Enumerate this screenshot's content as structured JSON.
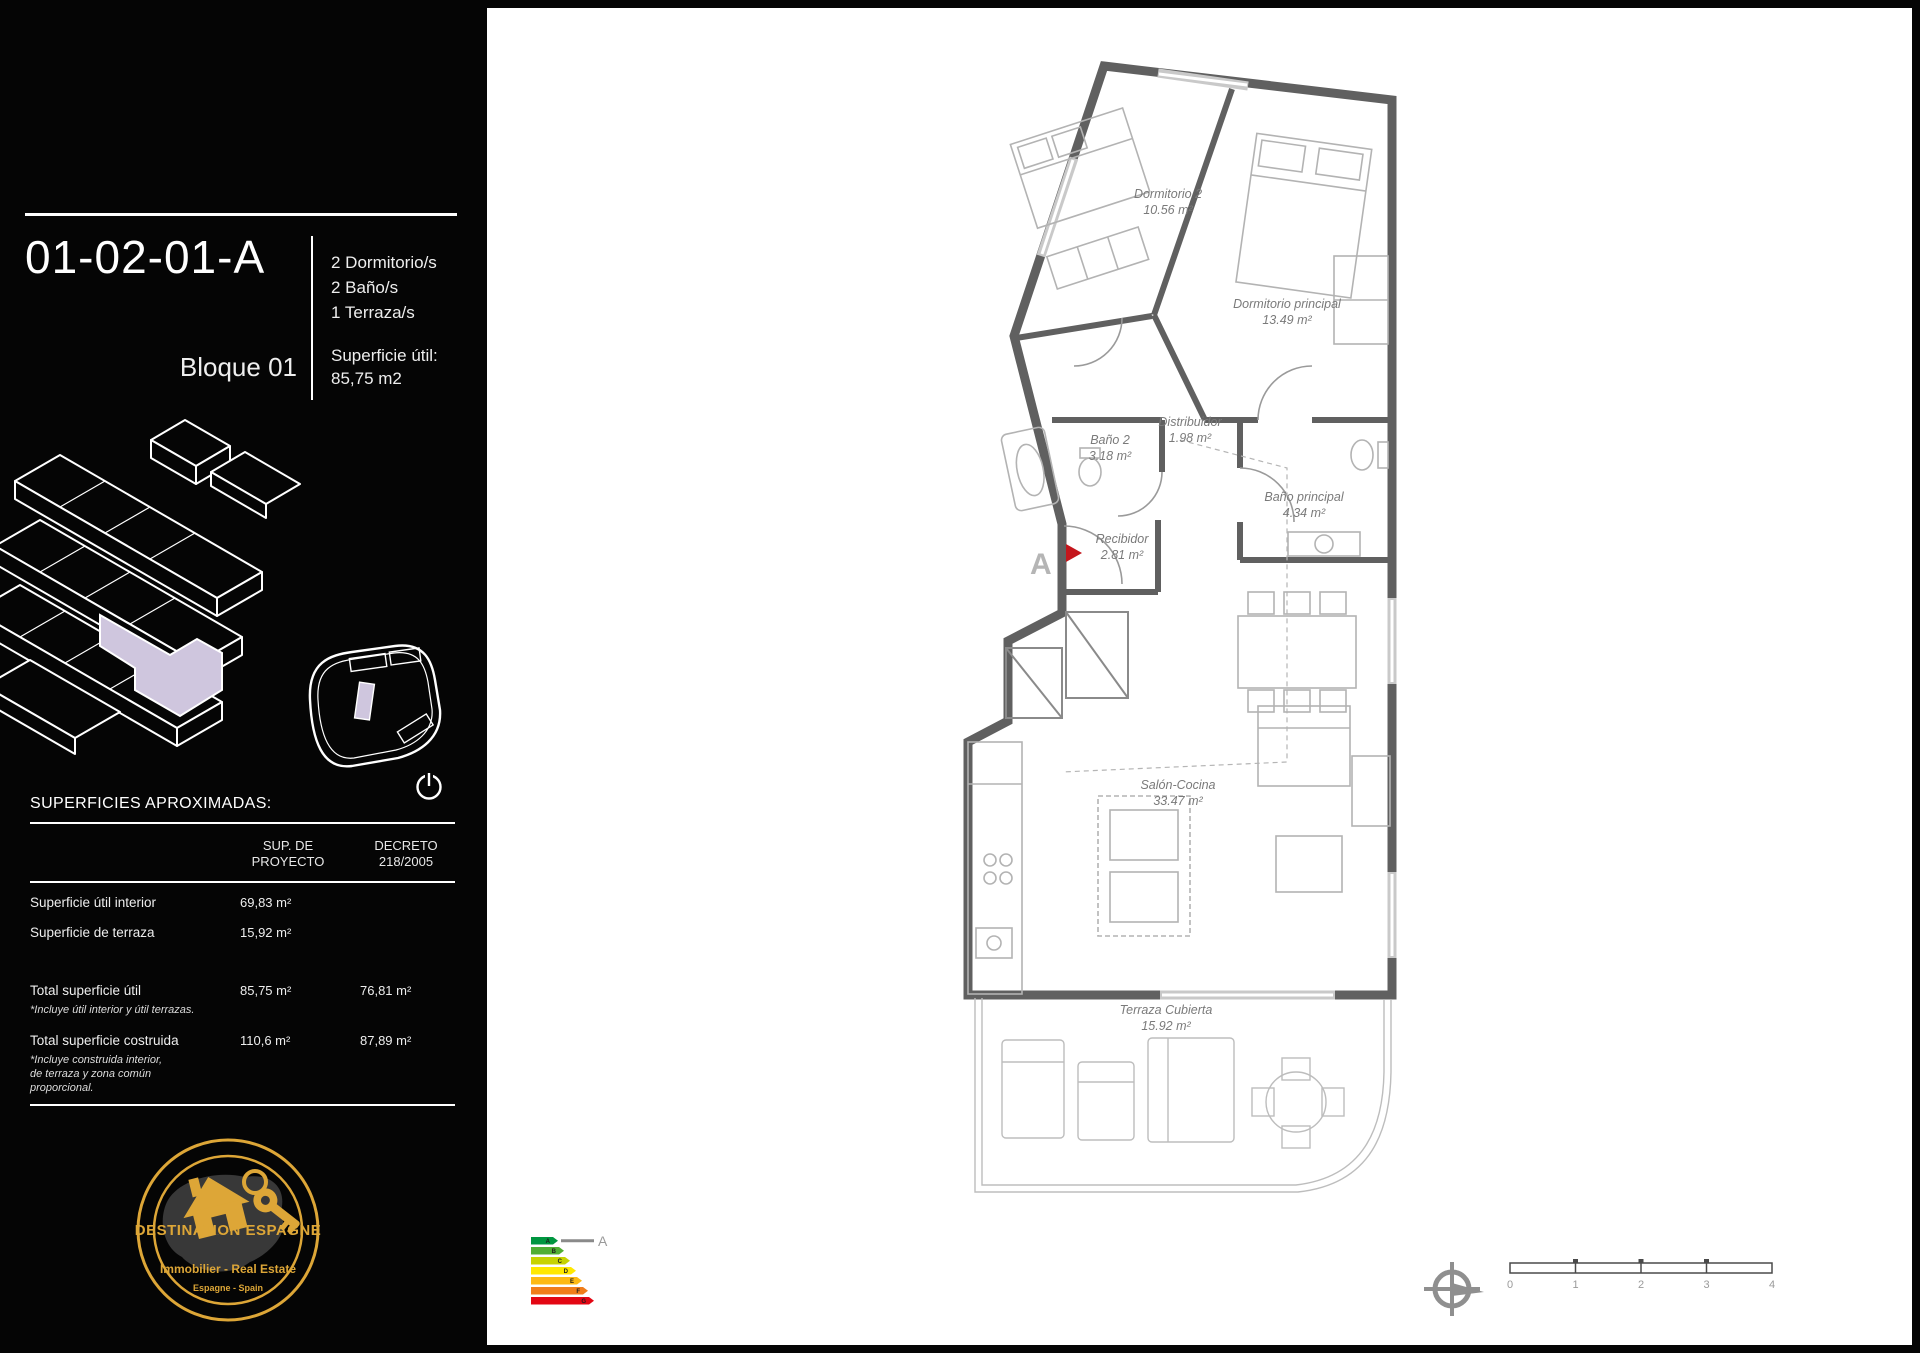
{
  "colors": {
    "gold": "#DDA637",
    "lavender": "#CFC6DE",
    "wall_gray": "#606060",
    "entrance_red": "#C4161C"
  },
  "sidebar": {
    "unit_code": "01-02-01-A",
    "block_label": "Bloque 01",
    "features": [
      "2 Dormitorio/s",
      "2 Baño/s",
      "1 Terraza/s"
    ],
    "superficie": {
      "label": "Superficie útil:",
      "value": "85,75  m2"
    },
    "surfaces_heading": "SUPERFICIES APROXIMADAS:",
    "table": {
      "headers": [
        "SUP. DE\nPROYECTO",
        "DECRETO\n218/2005"
      ],
      "rows": [
        {
          "label": "Superficie útil interior",
          "proyecto": "69,83  m²",
          "decreto": ""
        },
        {
          "label": "Superficie de terraza",
          "proyecto": "15,92  m²",
          "decreto": ""
        },
        {
          "label": "Total superficie útil",
          "note": "*Incluye útil interior y útil terrazas.",
          "proyecto": "85,75  m²",
          "decreto": "76,81  m²"
        },
        {
          "label": "Total superficie costruida",
          "note": "*Incluye construida interior,\nde terraza y zona común\nproporcional.",
          "proyecto": "110,6  m²",
          "decreto": "87,89  m²"
        }
      ]
    },
    "logo": {
      "title": "DESTINATION ESPAGNE",
      "subtitle": "Immobilier - Real Estate",
      "tagline": "Espagne - Spain"
    }
  },
  "plan": {
    "rooms": [
      {
        "name": "Dormitorio 2",
        "area": "10.56 m²"
      },
      {
        "name": "Dormitorio principal",
        "area": "13.49 m²"
      },
      {
        "name": "Baño 2",
        "area": "3.18 m²"
      },
      {
        "name": "Distribuidor",
        "area": "1.98 m²"
      },
      {
        "name": "Baño principal",
        "area": "4.34 m²"
      },
      {
        "name": "Recibidor",
        "area": "2.81 m²"
      },
      {
        "name": "Salón-Cocina",
        "area": "33.47 m²"
      },
      {
        "name": "Terraza Cubierta",
        "area": "15.92 m²"
      }
    ],
    "entrance_marker": "A",
    "energy": {
      "grades": [
        "A",
        "B",
        "C",
        "D",
        "E",
        "F",
        "G"
      ],
      "colors": [
        "#009640",
        "#50AE33",
        "#C7D301",
        "#FFE800",
        "#FDB913",
        "#F07D1A",
        "#E30613"
      ],
      "indicator": "A"
    },
    "scale_ticks": [
      "0",
      "1",
      "2",
      "3",
      "4"
    ]
  }
}
